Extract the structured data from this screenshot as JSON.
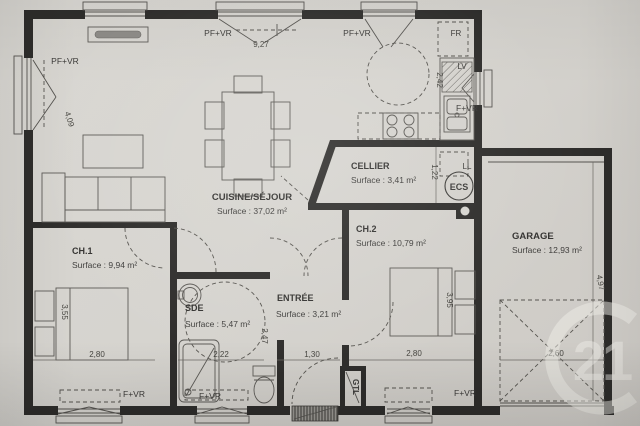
{
  "rooms": {
    "sejour": {
      "name": "CUISINE/SÉJOUR",
      "surface": "Surface : 37,02 m²"
    },
    "cellier": {
      "name": "CELLIER",
      "surface": "Surface : 3,41 m²"
    },
    "ch2": {
      "name": "CH.2",
      "surface": "Surface : 10,79 m²"
    },
    "garage": {
      "name": "GARAGE",
      "surface": "Surface : 12,93 m²"
    },
    "ch1": {
      "name": "CH.1",
      "surface": "Surface : 9,94 m²"
    },
    "sde": {
      "name": "SDE",
      "surface": "Surface : 5,47 m²"
    },
    "entree": {
      "name": "ENTRÉE",
      "surface": "Surface : 3,21 m²"
    }
  },
  "openings": {
    "pf_vr_top_center": "PF+VR",
    "pf_vr_top_right": "PF+VR",
    "pf_vr_left": "PF+VR",
    "f_vr_kitchen": "F+VR",
    "f_vr_ch1": "F+VR",
    "f_vr_sde": "F+VR",
    "f_vr_ch2": "F+VR"
  },
  "equipment": {
    "fr": "FR",
    "lv": "LV",
    "ll": "LL",
    "ecs": "ECS",
    "gtl": "GTL"
  },
  "dimensions": {
    "sejour_width": "9,27",
    "sejour_left_depth": "4,09",
    "kitchen_counter": "2,42",
    "cellier_depth": "1,22",
    "ch1_depth": "3,55",
    "ch1_width": "2,80",
    "sde_width": "2,22",
    "entree_depth": "2,47",
    "entree_width": "1,30",
    "ch2_depth": "3,95",
    "ch2_width": "2,80",
    "garage_door_width": "2,60",
    "garage_depth": "4,97"
  },
  "watermark": {
    "agency_number": "21"
  },
  "colors": {
    "paper": "#d6d4cf",
    "wall": "#2e2d2b",
    "ink": "#3b3a38"
  }
}
